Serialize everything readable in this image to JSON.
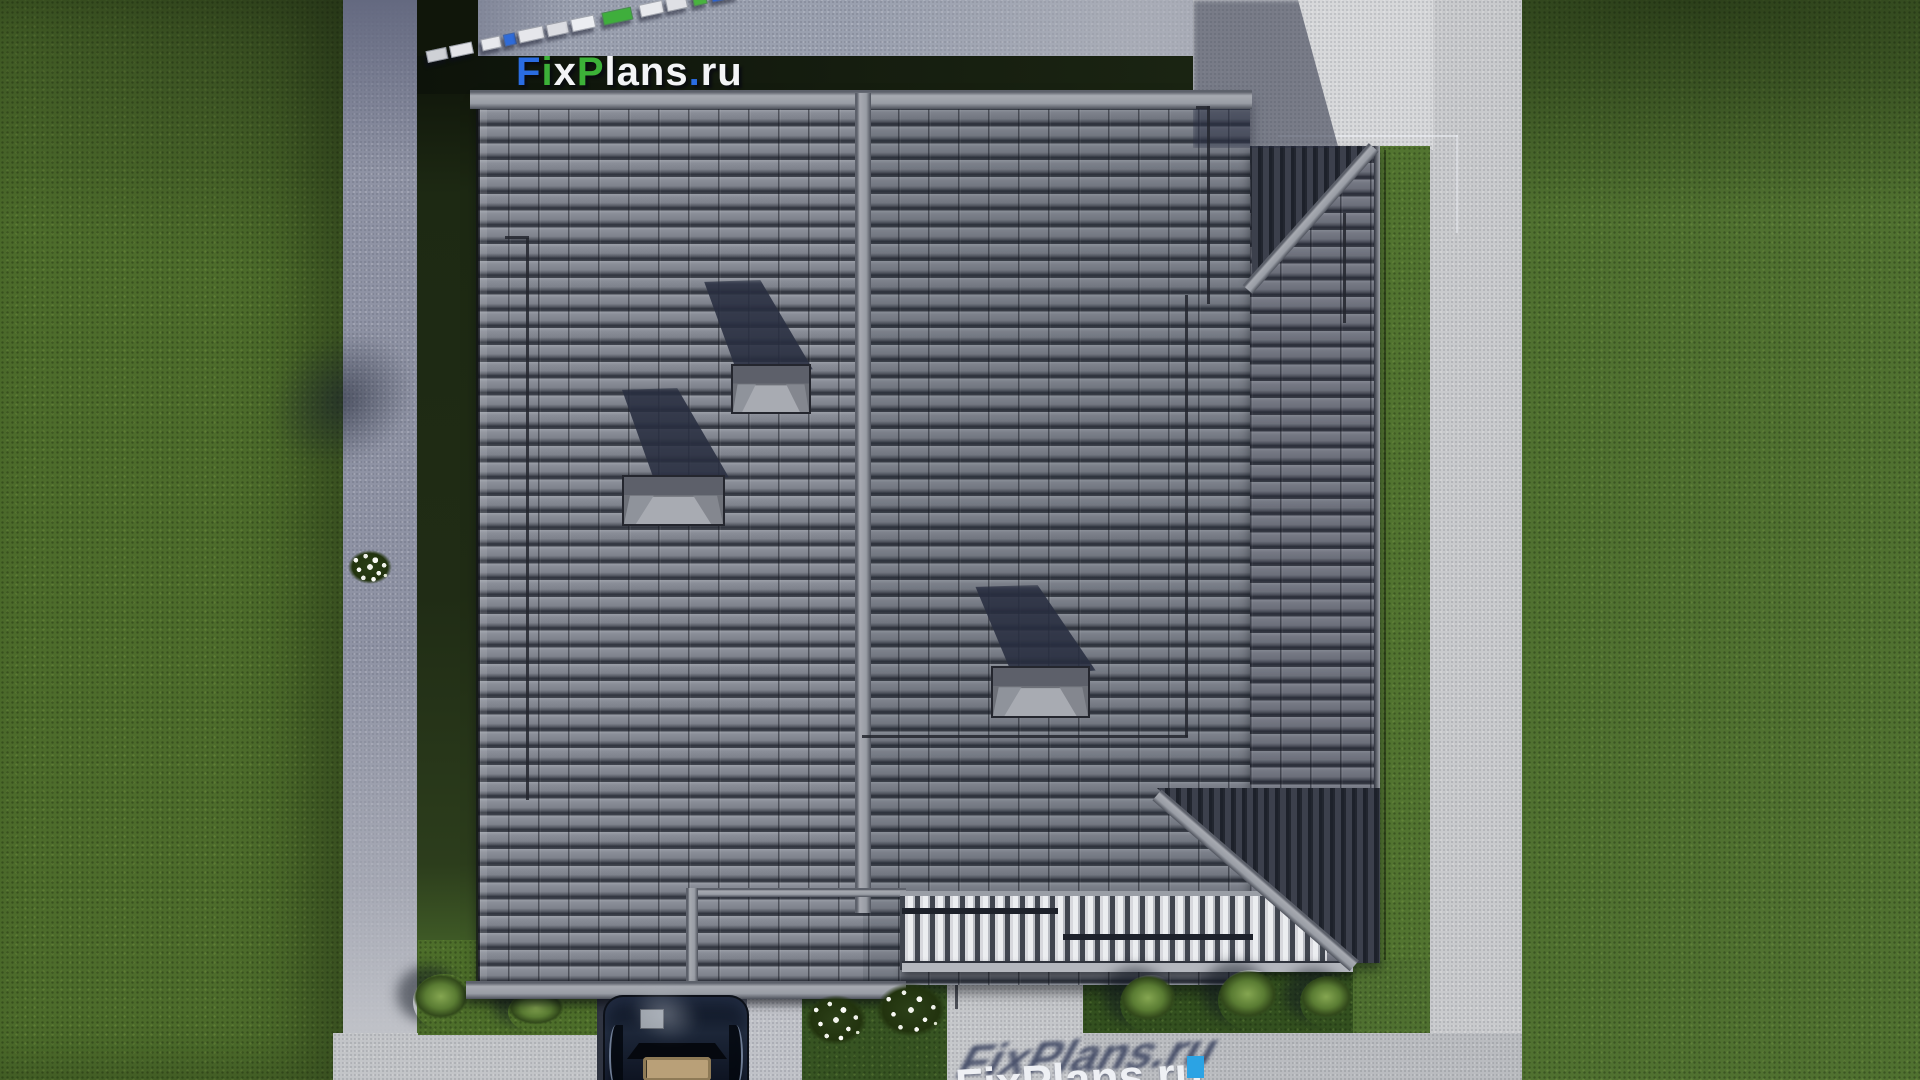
{
  "brand": {
    "name": "FixPlans.ru",
    "letters": [
      {
        "ch": "F",
        "color": "blue"
      },
      {
        "ch": "i",
        "color": "green"
      },
      {
        "ch": "x",
        "color": "white"
      },
      {
        "ch": "P",
        "color": "green"
      },
      {
        "ch": "l",
        "color": "white"
      },
      {
        "ch": "a",
        "color": "white"
      },
      {
        "ch": "n",
        "color": "white"
      },
      {
        "ch": "s",
        "color": "white"
      },
      {
        "ch": ".",
        "color": "blue"
      },
      {
        "ch": "r",
        "color": "white"
      },
      {
        "ch": "u",
        "color": "white"
      }
    ],
    "palette": {
      "blue": "#2a6ce2",
      "green": "#3cb138",
      "white": "#f3f4f6"
    }
  },
  "ground_watermark": {
    "text": "FixPlans.ru",
    "shadow_color": "#333c5a",
    "letter_color": "#eef0f4",
    "dot_color": "#2ba3e4"
  },
  "scale_bar": {
    "angle_deg": -12,
    "segments": [
      "width:21px;height:12px;background:#cfd1d6;margin-right:3px",
      "width:23px;height:12px;background:#e3e4e8;margin-right:9px",
      "width:20px;height:12px;background:#e8e9ed;margin-right:3px",
      "width:12px;height:12px;background:#2f6bd8;margin-right:3px",
      "width:26px;height:13px;background:#e6e7eb;margin-right:3px",
      "width:22px;height:13px;background:#dcdde2;margin-right:3px",
      "width:24px;height:13px;background:#eceef2;margin-right:8px",
      "width:30px;height:13px;background:#3fae3c;margin-right:8px",
      "width:24px;height:13px;background:#e8e9ed;margin-right:3px",
      "width:21px;height:13px;background:#dfe0e5;margin-right:6px",
      "width:14px;height:13px;background:#49b33f;margin-right:5px",
      "width:26px;height:17px;background:#2a62d4;margin-right:0"
    ]
  },
  "scene": {
    "counts": {
      "chimneys": 3,
      "green_bushes": 5,
      "flower_bushes": 3,
      "cars": 1
    },
    "palette": {
      "grass": "#4d6c2b",
      "grass_shadow": "#1d2913",
      "roof_tile": "#7e828c",
      "roof_gap": "#30343e",
      "ridge": "#a2a5ad",
      "pavement_bright": "#d7d8da",
      "pavement_shadow": "#8e92a3",
      "cast_shadow_navy": "#2d3344",
      "pergola_slat": "#eceef1",
      "car_body": "#111a2c"
    }
  }
}
